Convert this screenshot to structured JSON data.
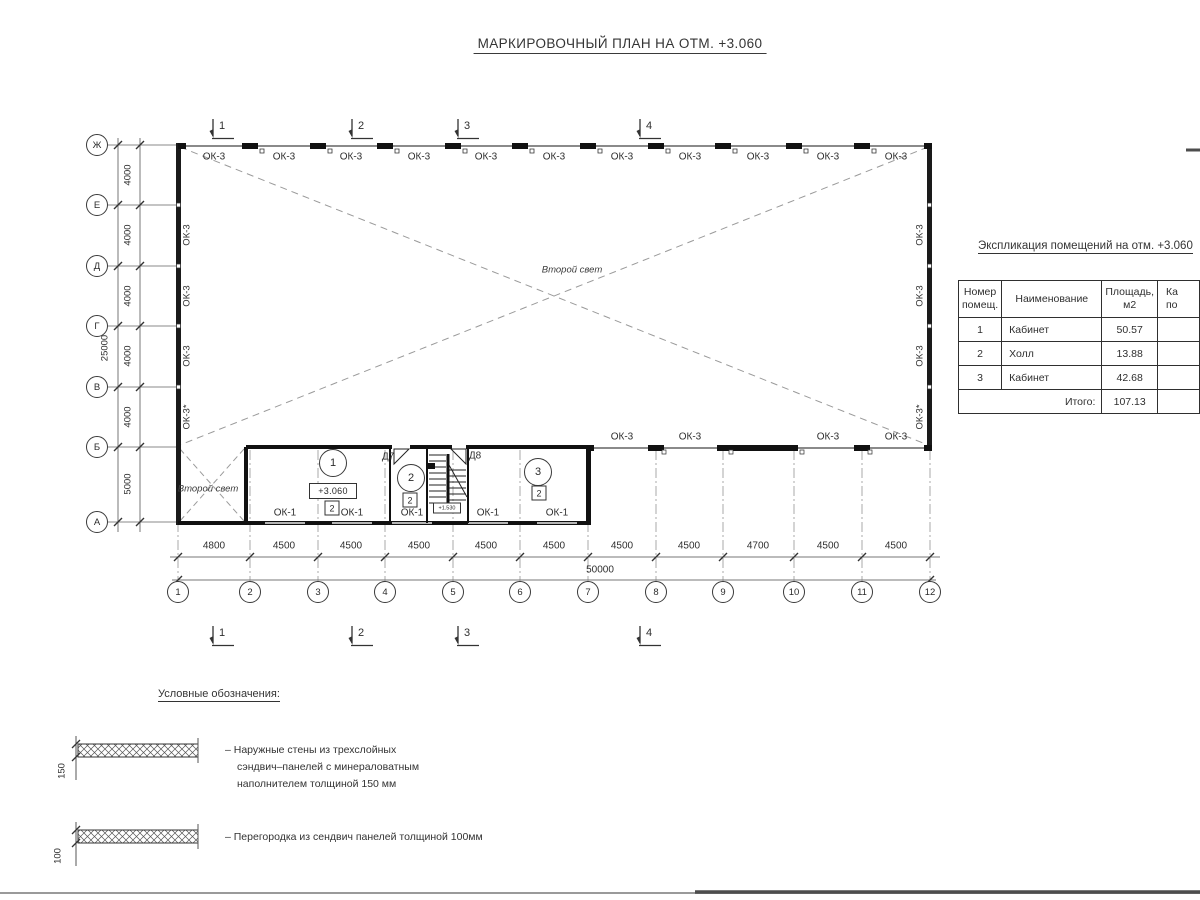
{
  "title": "МАРКИРОВОЧНЫЙ ПЛАН НА ОТМ. +3.060",
  "colors": {
    "ink": "#2b2b2b",
    "wall": "#1a1a1a",
    "window_band": "#8a8a8a",
    "dash": "#999999"
  },
  "plan": {
    "top_windows": [
      "ОК-3",
      "ОК-3",
      "ОК-3",
      "ОК-3",
      "ОК-3",
      "ОК-3",
      "ОК-3",
      "ОК-3",
      "ОК-3",
      "ОК-3",
      "ОК-3"
    ],
    "left_windows": [
      "ОК-3",
      "ОК-3",
      "ОК-3",
      "ОК-3*"
    ],
    "right_windows": [
      "ОК-3",
      "ОК-3",
      "ОК-3",
      "ОК-3*"
    ],
    "mid_windows": [
      "ОК-3",
      "ОК-3",
      "ОК-3",
      "ОК-3"
    ],
    "bottom_windows": [
      "ОК-1",
      "ОК-1",
      "ОК-1",
      "ОК-1",
      "ОК-1"
    ],
    "second_light_label": "Второй свет",
    "rooms": [
      {
        "number": "1"
      },
      {
        "number": "2"
      },
      {
        "number": "3"
      }
    ],
    "room_badge": "2",
    "elevation_label": "+3.060",
    "stair_elevation": "+1.530",
    "doors": [
      "Д7",
      "Д8"
    ],
    "axes_letters": [
      "Ж",
      "Е",
      "Д",
      "Г",
      "В",
      "Б",
      "А"
    ],
    "axes_numbers": [
      "1",
      "2",
      "3",
      "4",
      "5",
      "6",
      "7",
      "8",
      "9",
      "10",
      "11",
      "12"
    ],
    "dims_left": [
      "4000",
      "4000",
      "4000",
      "4000",
      "4000",
      "5000"
    ],
    "dim_left_total": "25000",
    "dims_bottom": [
      "4800",
      "4500",
      "4500",
      "4500",
      "4500",
      "4500",
      "4500",
      "4500",
      "4700",
      "4500",
      "4500"
    ],
    "dim_bottom_total": "50000",
    "section_markers": [
      "1",
      "2",
      "3",
      "4"
    ]
  },
  "table": {
    "heading": "Экспликация помещений на отм. +3.060",
    "col_number": "Номер\nпомещ.",
    "col_name": "Наименование",
    "col_area": "Площадь,\nм2",
    "col_cut": "Ка\nпо",
    "rows": [
      {
        "num": "1",
        "name": "Кабинет",
        "area": "50.57"
      },
      {
        "num": "2",
        "name": "Холл",
        "area": "13.88"
      },
      {
        "num": "3",
        "name": "Кабинет",
        "area": "42.68"
      }
    ],
    "total_label": "Итого:",
    "total_value": "107.13"
  },
  "legend": {
    "heading": "Условные обозначения:",
    "items": [
      {
        "dim": "150",
        "text": "– Наружные стены из трехслойных\nсэндвич–панелей с минераловатным\nнаполнителем толщиной 150 мм"
      },
      {
        "dim": "100",
        "text": "– Перегородка из сендвич панелей толщиной 100мм"
      }
    ]
  }
}
